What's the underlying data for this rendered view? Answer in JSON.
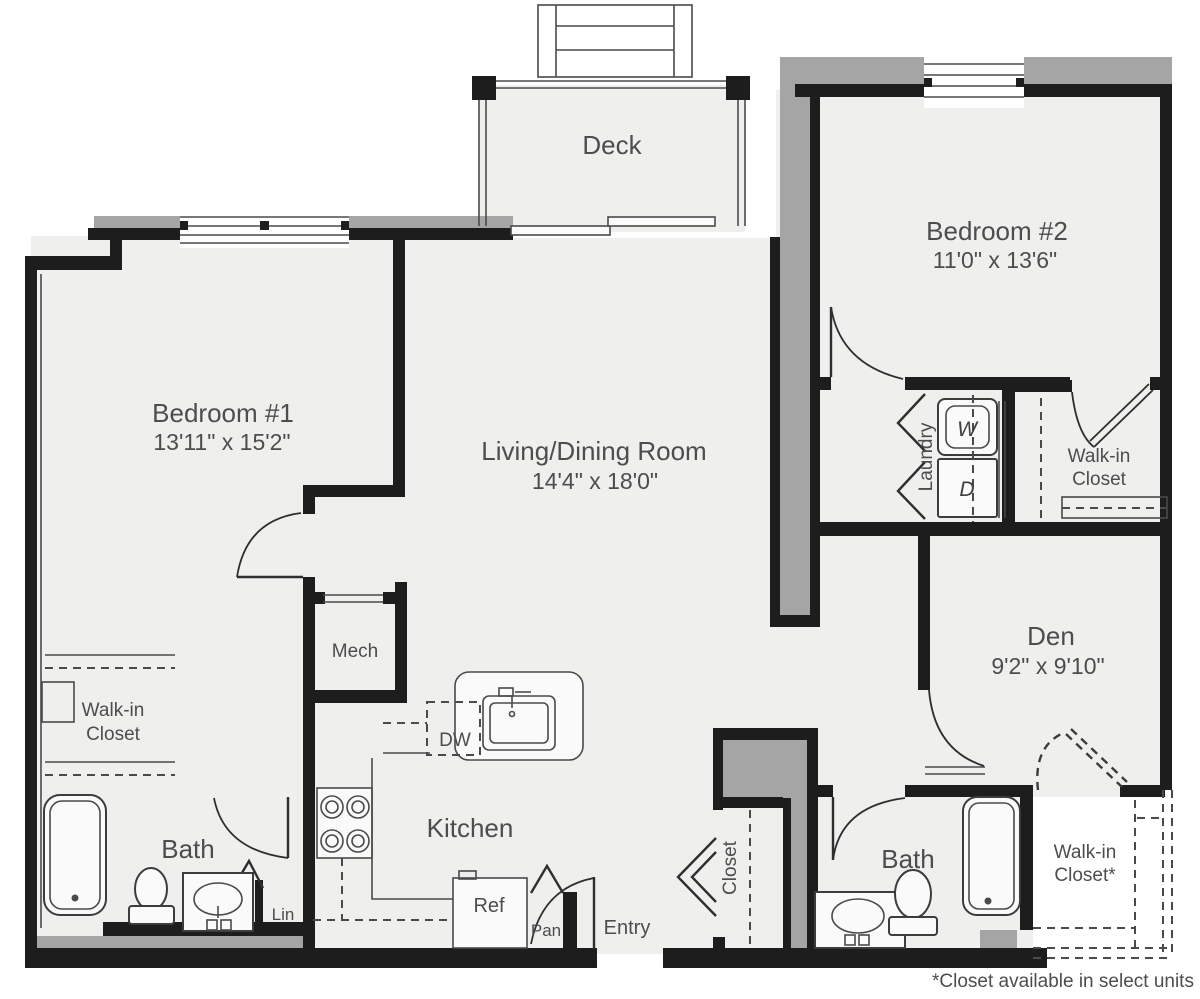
{
  "floor_plan": {
    "rooms": {
      "deck": {
        "label": "Deck"
      },
      "bedroom1": {
        "label": "Bedroom #1",
        "dims": "13'11\" x 15'2\""
      },
      "bedroom2": {
        "label": "Bedroom #2",
        "dims": "11'0\" x 13'6\""
      },
      "living": {
        "label": "Living/Dining Room",
        "dims": "14'4\" x 18'0\""
      },
      "den": {
        "label": "Den",
        "dims": "9'2\" x 9'10\""
      },
      "kitchen": {
        "label": "Kitchen"
      },
      "mech": {
        "label": "Mech"
      },
      "bath1": {
        "label": "Bath"
      },
      "bath2": {
        "label": "Bath"
      },
      "laundry": {
        "label": "Laundry"
      },
      "entry": {
        "label": "Entry"
      },
      "closet_entry": {
        "label": "Closet"
      },
      "wic_left": {
        "line1": "Walk-in",
        "line2": "Closet"
      },
      "wic_right": {
        "line1": "Walk-in",
        "line2": "Closet"
      },
      "wic_optional": {
        "line1": "Walk-in",
        "line2": "Closet*"
      }
    },
    "fixtures": {
      "washer": "W",
      "dryer": "D",
      "dishwasher": "DW",
      "refrigerator": "Ref",
      "pantry": "Pan",
      "linen": "Lin"
    },
    "footnote": "*Closet available in select units",
    "colors": {
      "wall": "#1d1d1d",
      "exterior_band": "#a5a5a5",
      "floor": "#efefee",
      "text": "#4d4d4d"
    }
  }
}
